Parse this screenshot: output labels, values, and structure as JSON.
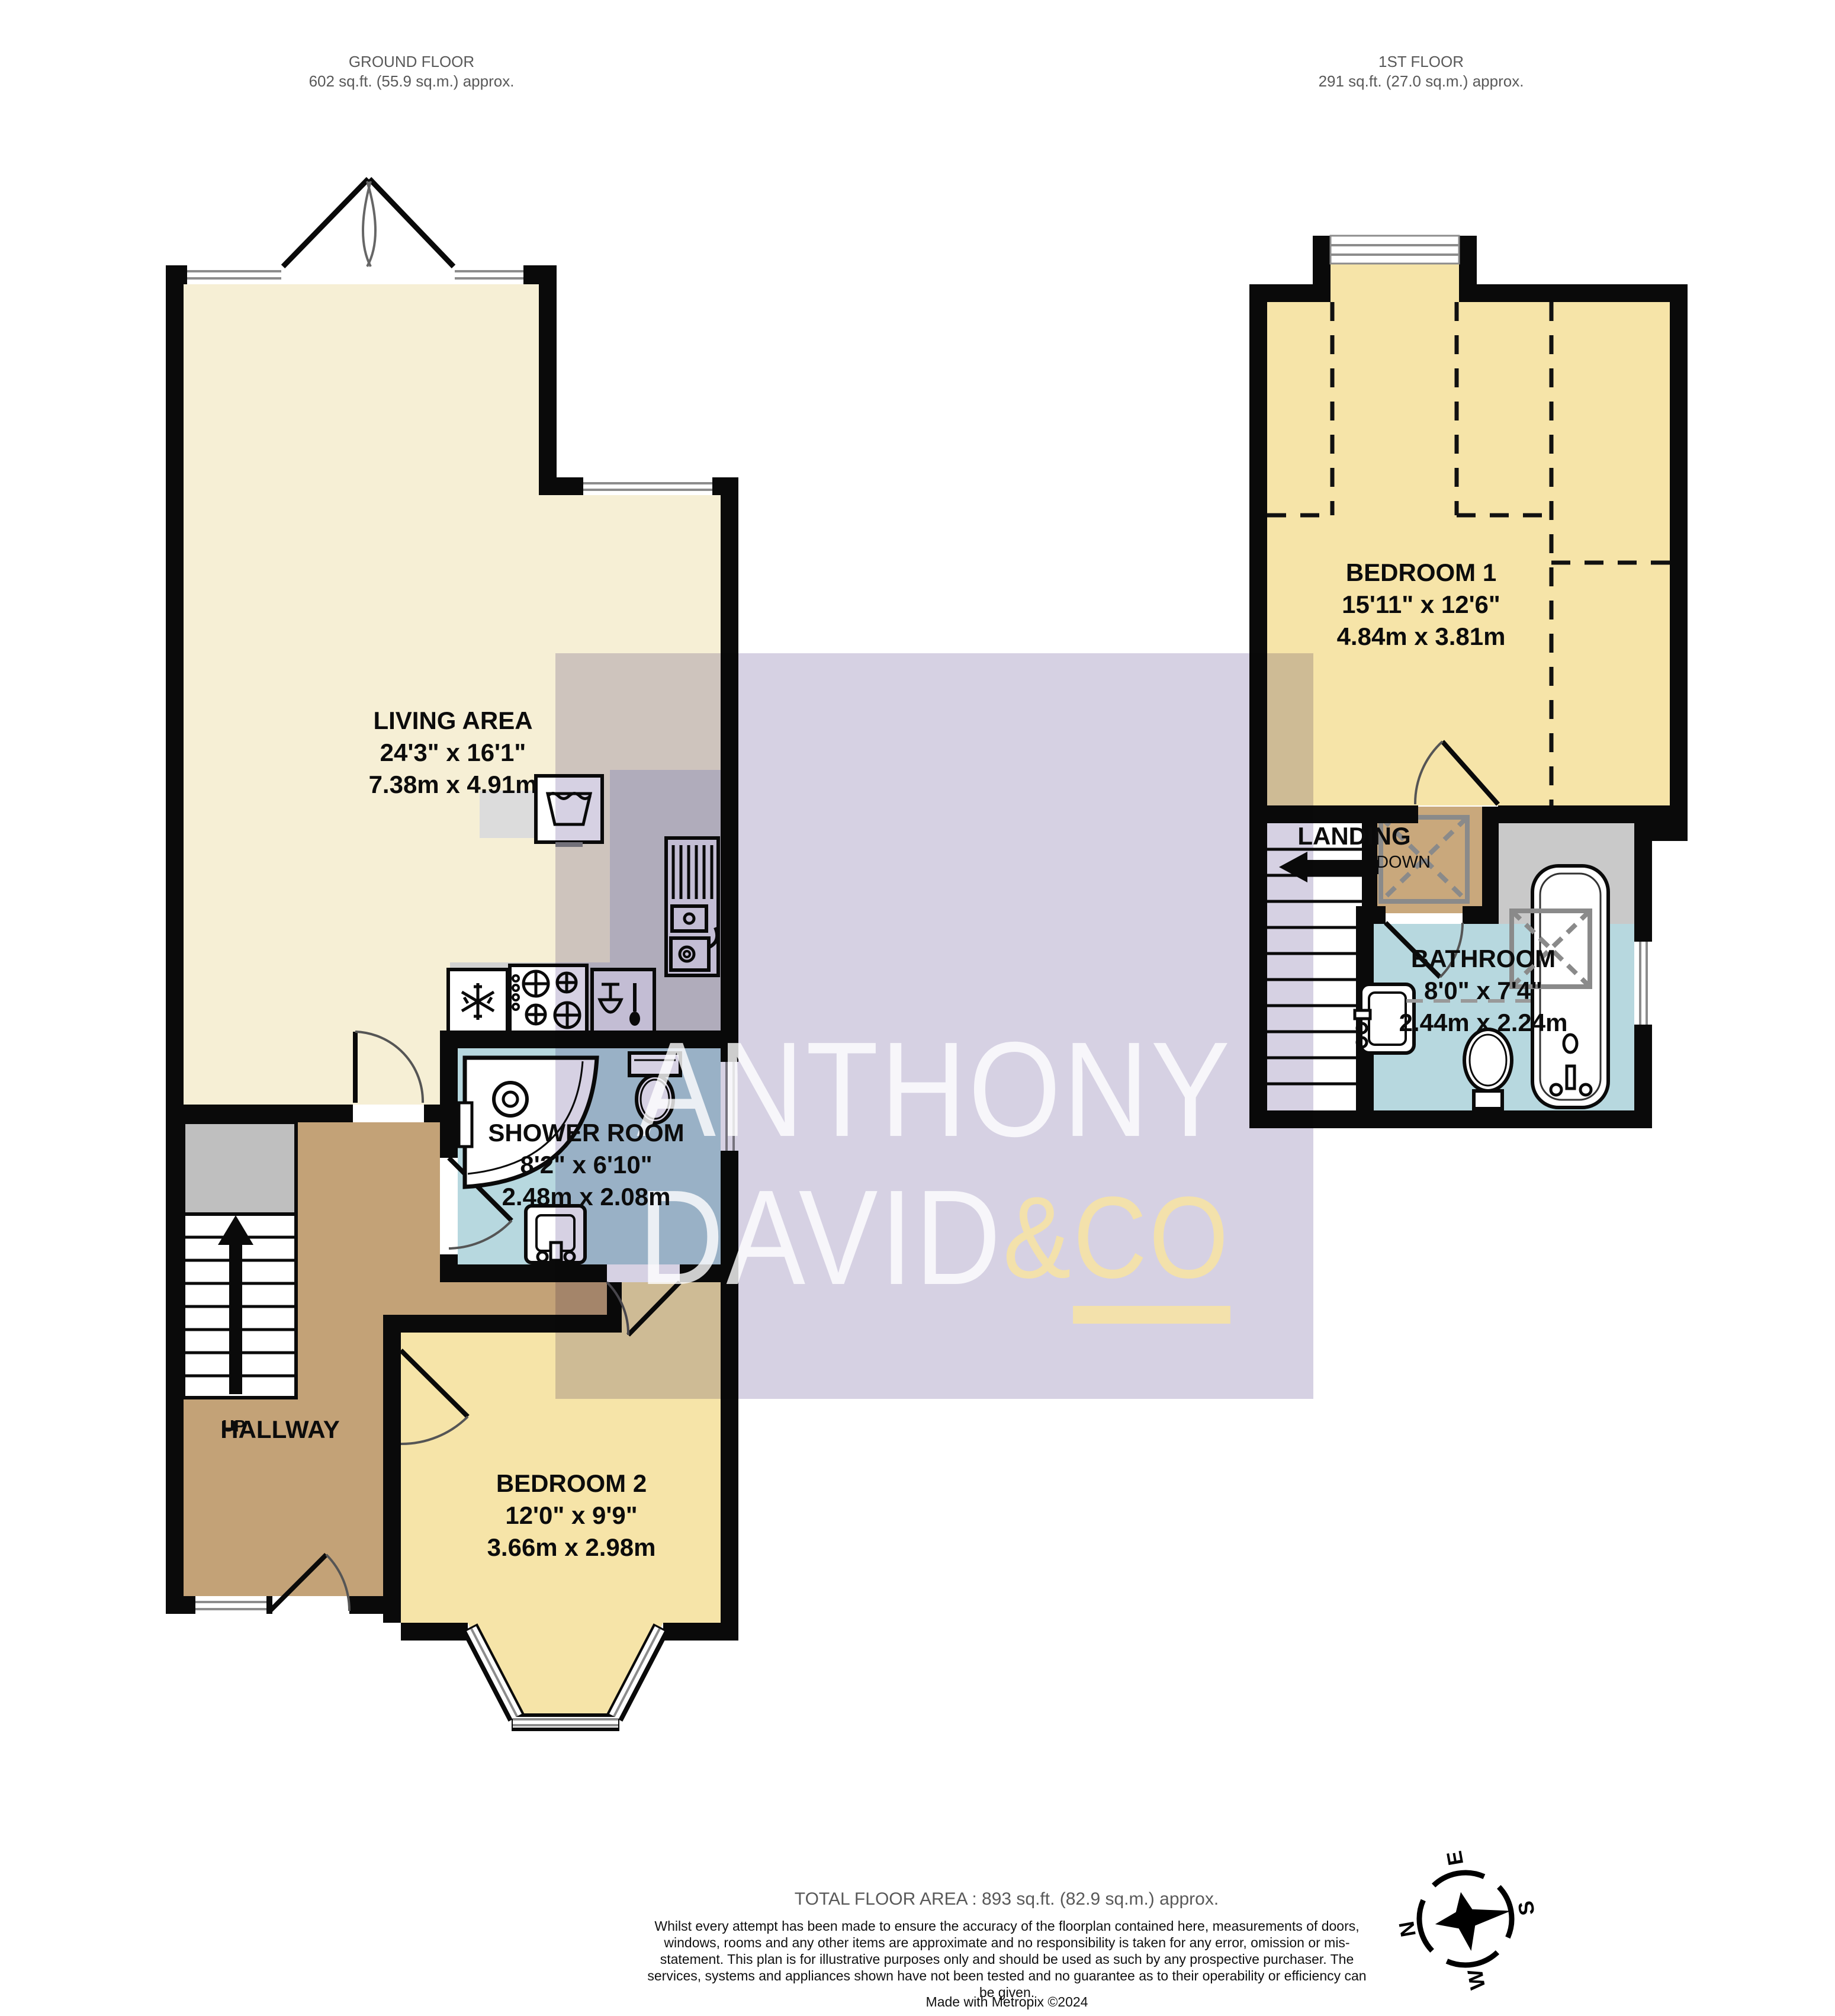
{
  "headers": {
    "ground": {
      "title": "GROUND FLOOR",
      "area": "602 sq.ft. (55.9 sq.m.) approx."
    },
    "first": {
      "title": "1ST FLOOR",
      "area": "291 sq.ft. (27.0 sq.m.) approx."
    }
  },
  "rooms": {
    "living": {
      "name": "LIVING AREA",
      "imperial": "24'3\"  x 16'1\"",
      "metric": "7.38m  x 4.91m"
    },
    "shower": {
      "name": "SHOWER ROOM",
      "imperial": "8'2\"  x 6'10\"",
      "metric": "2.48m  x 2.08m"
    },
    "bedroom2": {
      "name": "BEDROOM 2",
      "imperial": "12'0\"  x 9'9\"",
      "metric": "3.66m  x 2.98m"
    },
    "bedroom1": {
      "name": "BEDROOM 1",
      "imperial": "15'11\"  x 12'6\"",
      "metric": "4.84m  x 3.81m"
    },
    "bathroom": {
      "name": "BATHROOM",
      "imperial": "8'0\"  x 7'4\"",
      "metric": "2.44m  x 2.24m"
    }
  },
  "labels": {
    "hallway": "HALLWAY",
    "up": "UP",
    "landing": "LANDING",
    "down": "DOWN"
  },
  "watermark": {
    "line1": "ANTHONY",
    "line2": "DAVID",
    "amp": "&",
    "co": "CO"
  },
  "footer": {
    "total": "TOTAL FLOOR AREA : 893 sq.ft. (82.9 sq.m.) approx.",
    "disclaimer": "Whilst every attempt has been made to ensure the accuracy of the floorplan contained here, measurements of doors, windows, rooms and any other items are approximate and no responsibility is taken for any error, omission or mis-statement. This plan is for illustrative purposes only and should be used as such by any prospective purchaser. The services, systems and appliances shown have not been tested and no guarantee as to their operability or efficiency can be given.",
    "made_with": "Made with Metropix ©2024"
  },
  "compass": {
    "n": "N",
    "e": "E",
    "s": "S",
    "w": "W"
  },
  "colors": {
    "wall": "#0a0a0a",
    "living_fill": "#f6efd5",
    "bedroom_fill": "#f6e4a8",
    "wet_room_fill": "#b7d8df",
    "hallway_fill": "#c3a277",
    "rooflight_fill": "#c9a87c",
    "counter_gray": "#d2d2d2",
    "watermark_lavender": "#d6d1e3",
    "watermark_gold": "#f4e2a8",
    "header_gray": "#595959"
  },
  "icons": {
    "compass": "compass-rose-icon",
    "fridge": "snowflake-icon",
    "hob": "four-burner-hob-icon",
    "dishwasher": "glass-and-spoon-icon",
    "washer": "basin-with-water-icon",
    "sink": "sink-drainer-icon"
  }
}
